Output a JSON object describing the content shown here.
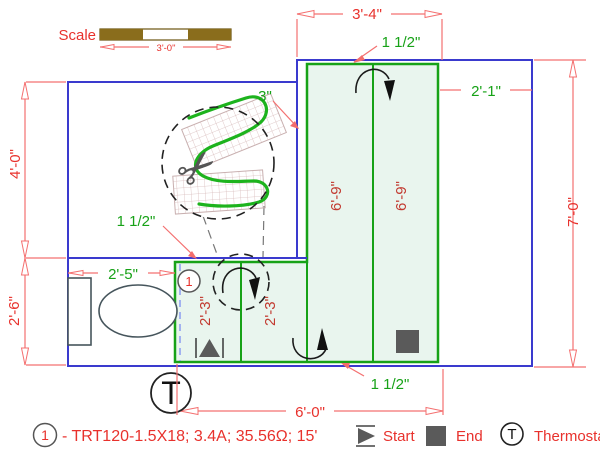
{
  "colors": {
    "dimension_red": "#e8312c",
    "dim_line_red": "#f47070",
    "annotation_green": "#17a217",
    "interior_red": "#c23a30",
    "wall_blue": "#3a3ace",
    "mat_fill": "#e9f5ee",
    "marker_gray": "#5a5a5a",
    "scale_bar_brown": "#8a6d1c"
  },
  "scale": {
    "label": "Scale",
    "value": "3'-0\""
  },
  "dims": {
    "top_width": "3'-4\"",
    "gap_top": "1 1/2\"",
    "gap_side": "3\"",
    "right_room_width": "2'-1\"",
    "left_upper": "4'-0\"",
    "left_lower": "2'-6\"",
    "total_height": "7'-0\"",
    "bottom_width": "6'-0\"",
    "toilet_room_width": "2'-5\"",
    "gap_left": "1 1/2\"",
    "gap_bottom": "1 1/2\"",
    "mat_col_tall_1": "6'-9\"",
    "mat_col_tall_2": "6'-9\"",
    "mat_col_short_1": "2'-3\"",
    "mat_col_short_2": "2'-3\""
  },
  "plan": {
    "circuit_number": "1",
    "thermostat_letter": "T"
  },
  "legend": {
    "circuit_number": "1",
    "circuit_spec": "- TRT120-1.5X18; 3.4A; 35.56Ω; 15'",
    "start_label": "Start",
    "end_label": "End",
    "thermostat_letter": "T",
    "thermostat_label": "Thermostat"
  }
}
